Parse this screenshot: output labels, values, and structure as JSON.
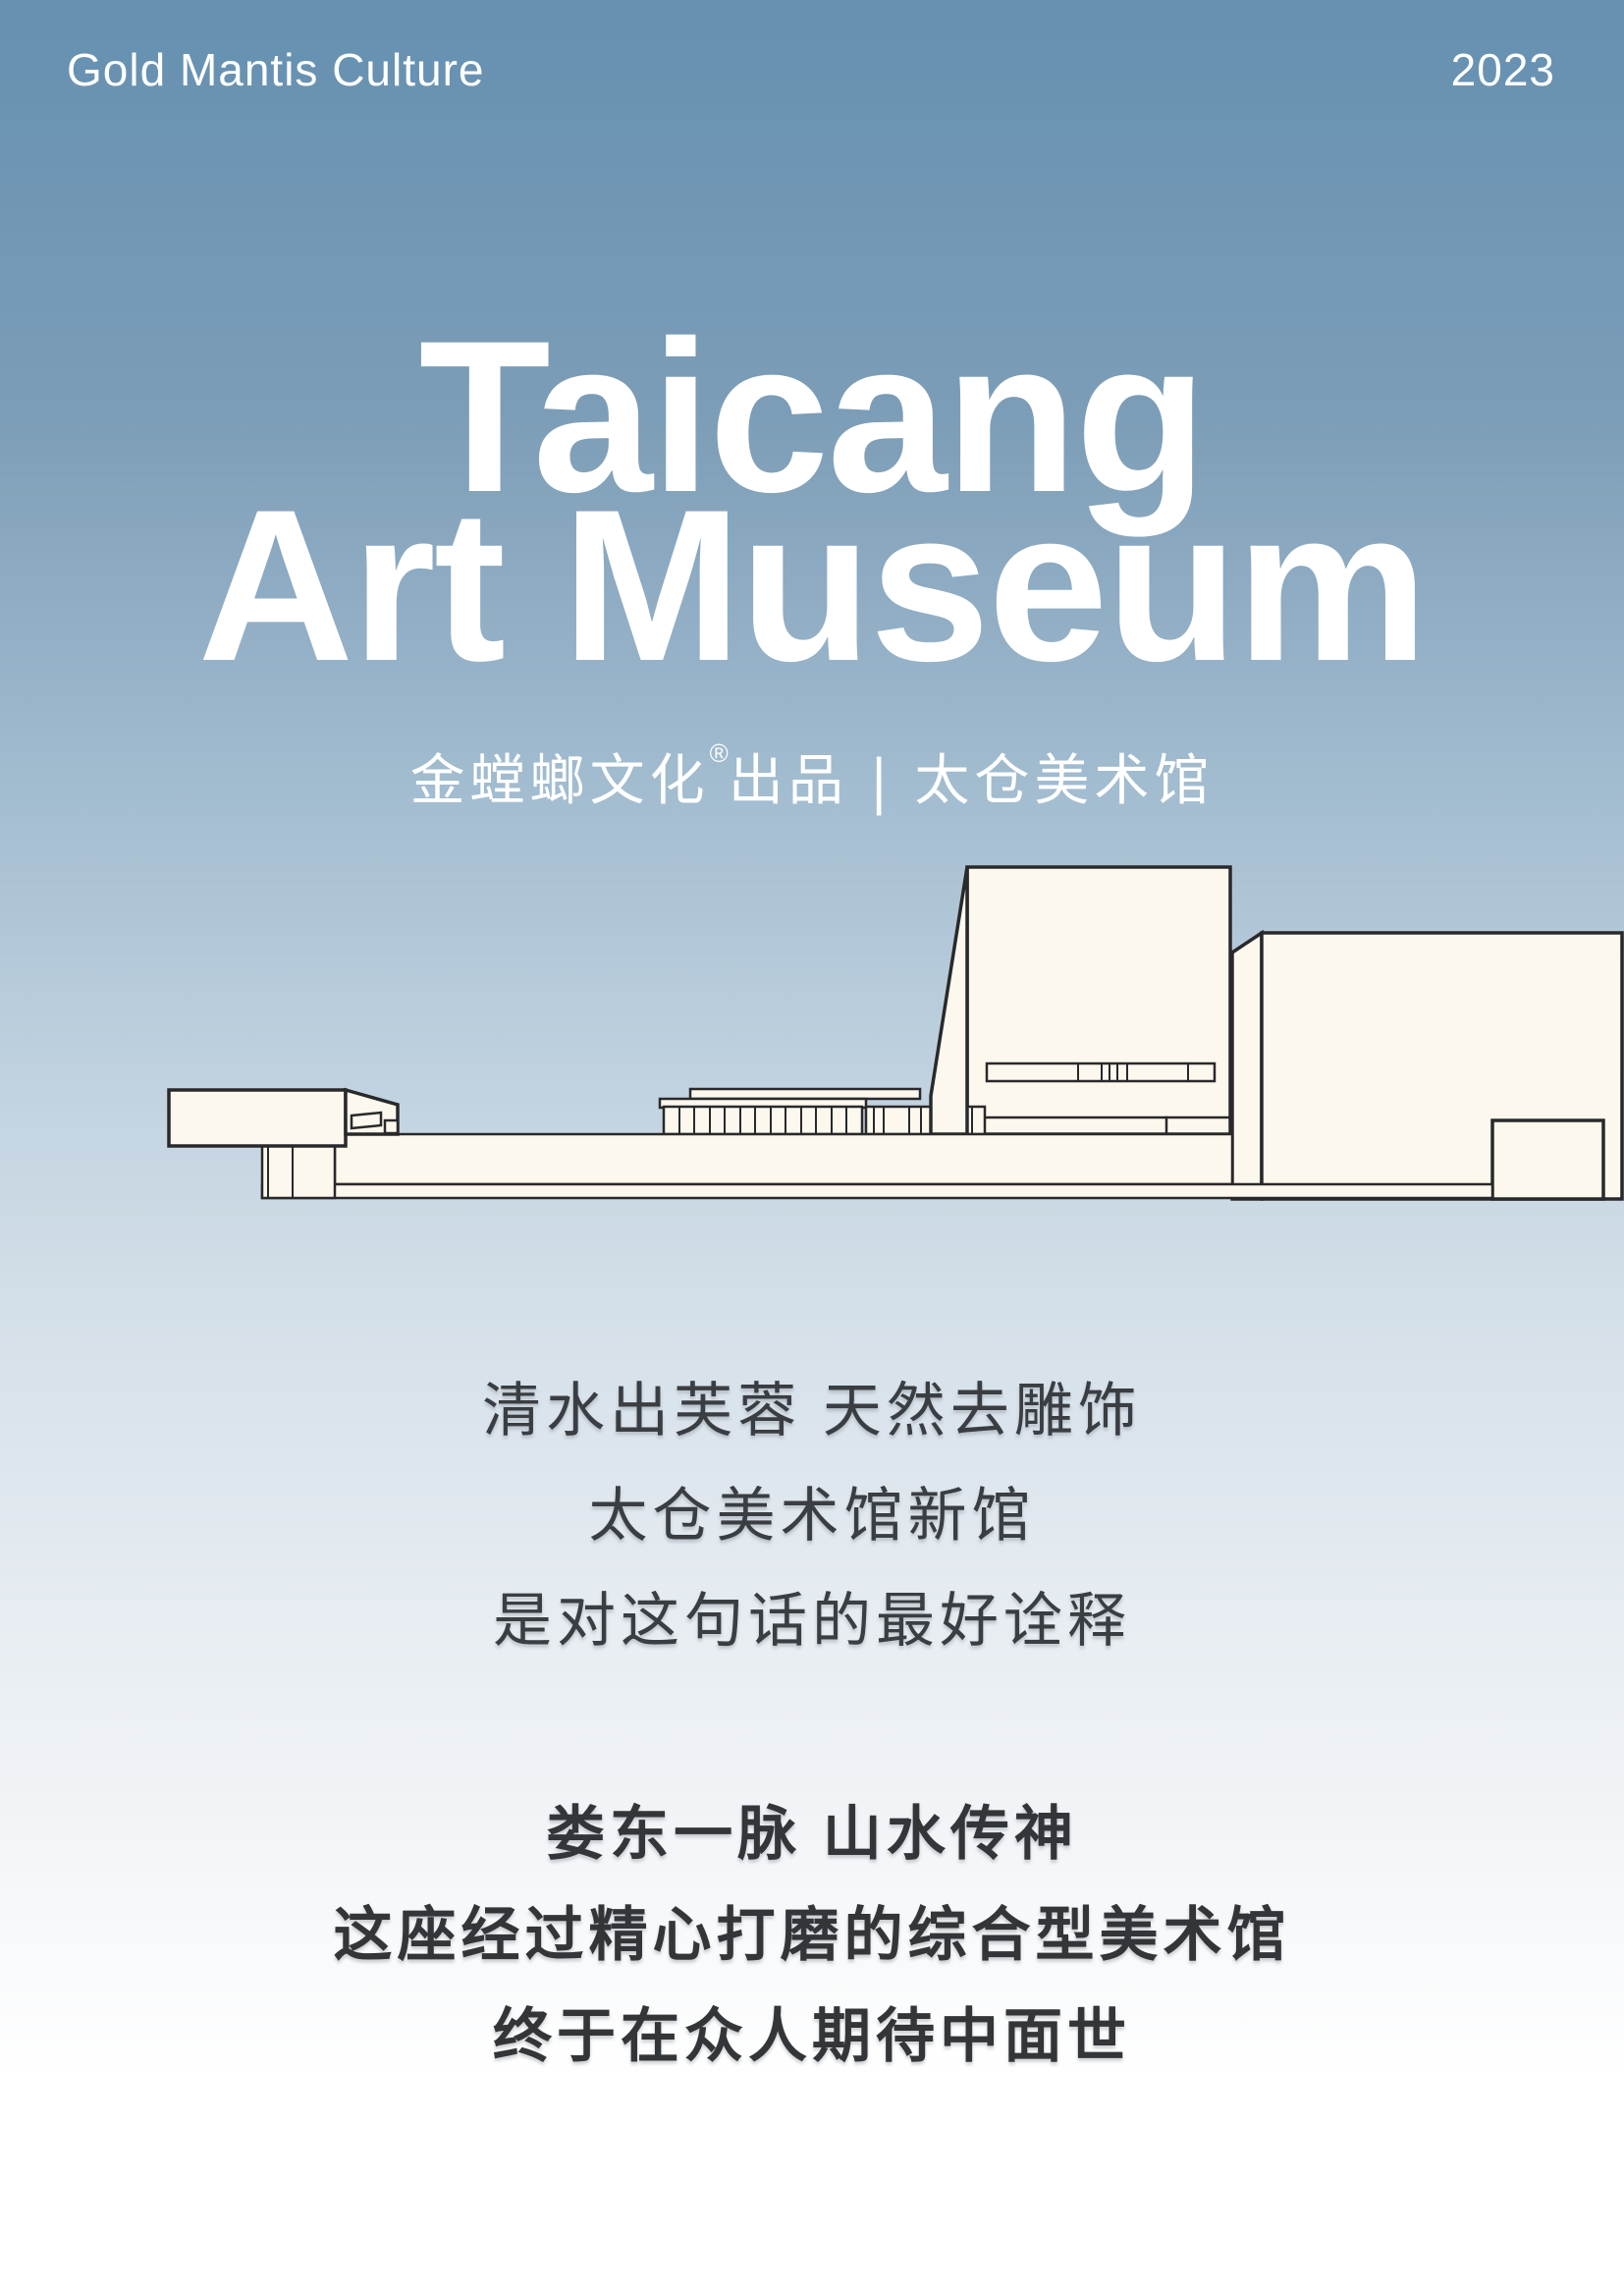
{
  "header": {
    "brand": "Gold Mantis Culture",
    "year": "2023"
  },
  "title": {
    "line1": "Taicang",
    "line2": "Art Museum"
  },
  "subtitle": {
    "producer": "金螳螂文化",
    "reg_mark": "®",
    "suffix": "出品",
    "divider": "|",
    "museum": "太仓美术馆"
  },
  "intro": {
    "line1": "清水出芙蓉 天然去雕饰",
    "line2": "太仓美术馆新馆",
    "line3": "是对这句话的最好诠释"
  },
  "outro": {
    "line1": "娄东一脉 山水传神",
    "line2": "这座经过精心打磨的综合型美术馆",
    "line3": "终于在众人期待中面世"
  },
  "illustration": {
    "subject": "太仓美术馆建筑线稿"
  },
  "colors": {
    "background_top": "#6590b1",
    "background_bottom": "#ffffff",
    "building_fill": "#fdf8ee",
    "building_outline": "#29292b",
    "heading_text": "#ffffff",
    "body_text": "#3a3e42"
  }
}
